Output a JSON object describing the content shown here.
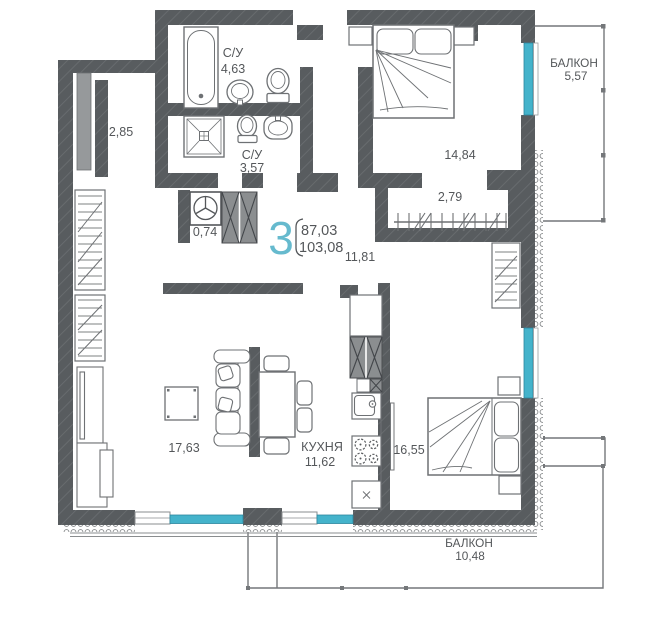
{
  "apartment": {
    "rooms_count": "3",
    "area_living": "87,03",
    "area_total": "103,08"
  },
  "rooms": {
    "bath1": {
      "name": "С/У",
      "area": "4,63"
    },
    "bath2": {
      "name": "С/У",
      "area": "3,57"
    },
    "vent": {
      "area": "0,74"
    },
    "left_storage": {
      "area": "2,85"
    },
    "hall": {
      "area": "11,81"
    },
    "bedroom1": {
      "area": "14,84"
    },
    "closet": {
      "area": "2,79"
    },
    "balcony_right": {
      "name": "БАЛКОН",
      "area": "5,57"
    },
    "living": {
      "area": "17,63"
    },
    "kitchen": {
      "name": "КУХНЯ",
      "area": "11,62"
    },
    "bedroom2": {
      "area": "16,55"
    },
    "balcony_bottom": {
      "name": "БАЛКОН",
      "area": "10,48"
    }
  },
  "colors": {
    "wall": "#585c5f",
    "window": "#44b3cb",
    "accent_number": "#66bace",
    "text": "#54575a",
    "furniture_stroke": "#6e7174"
  }
}
